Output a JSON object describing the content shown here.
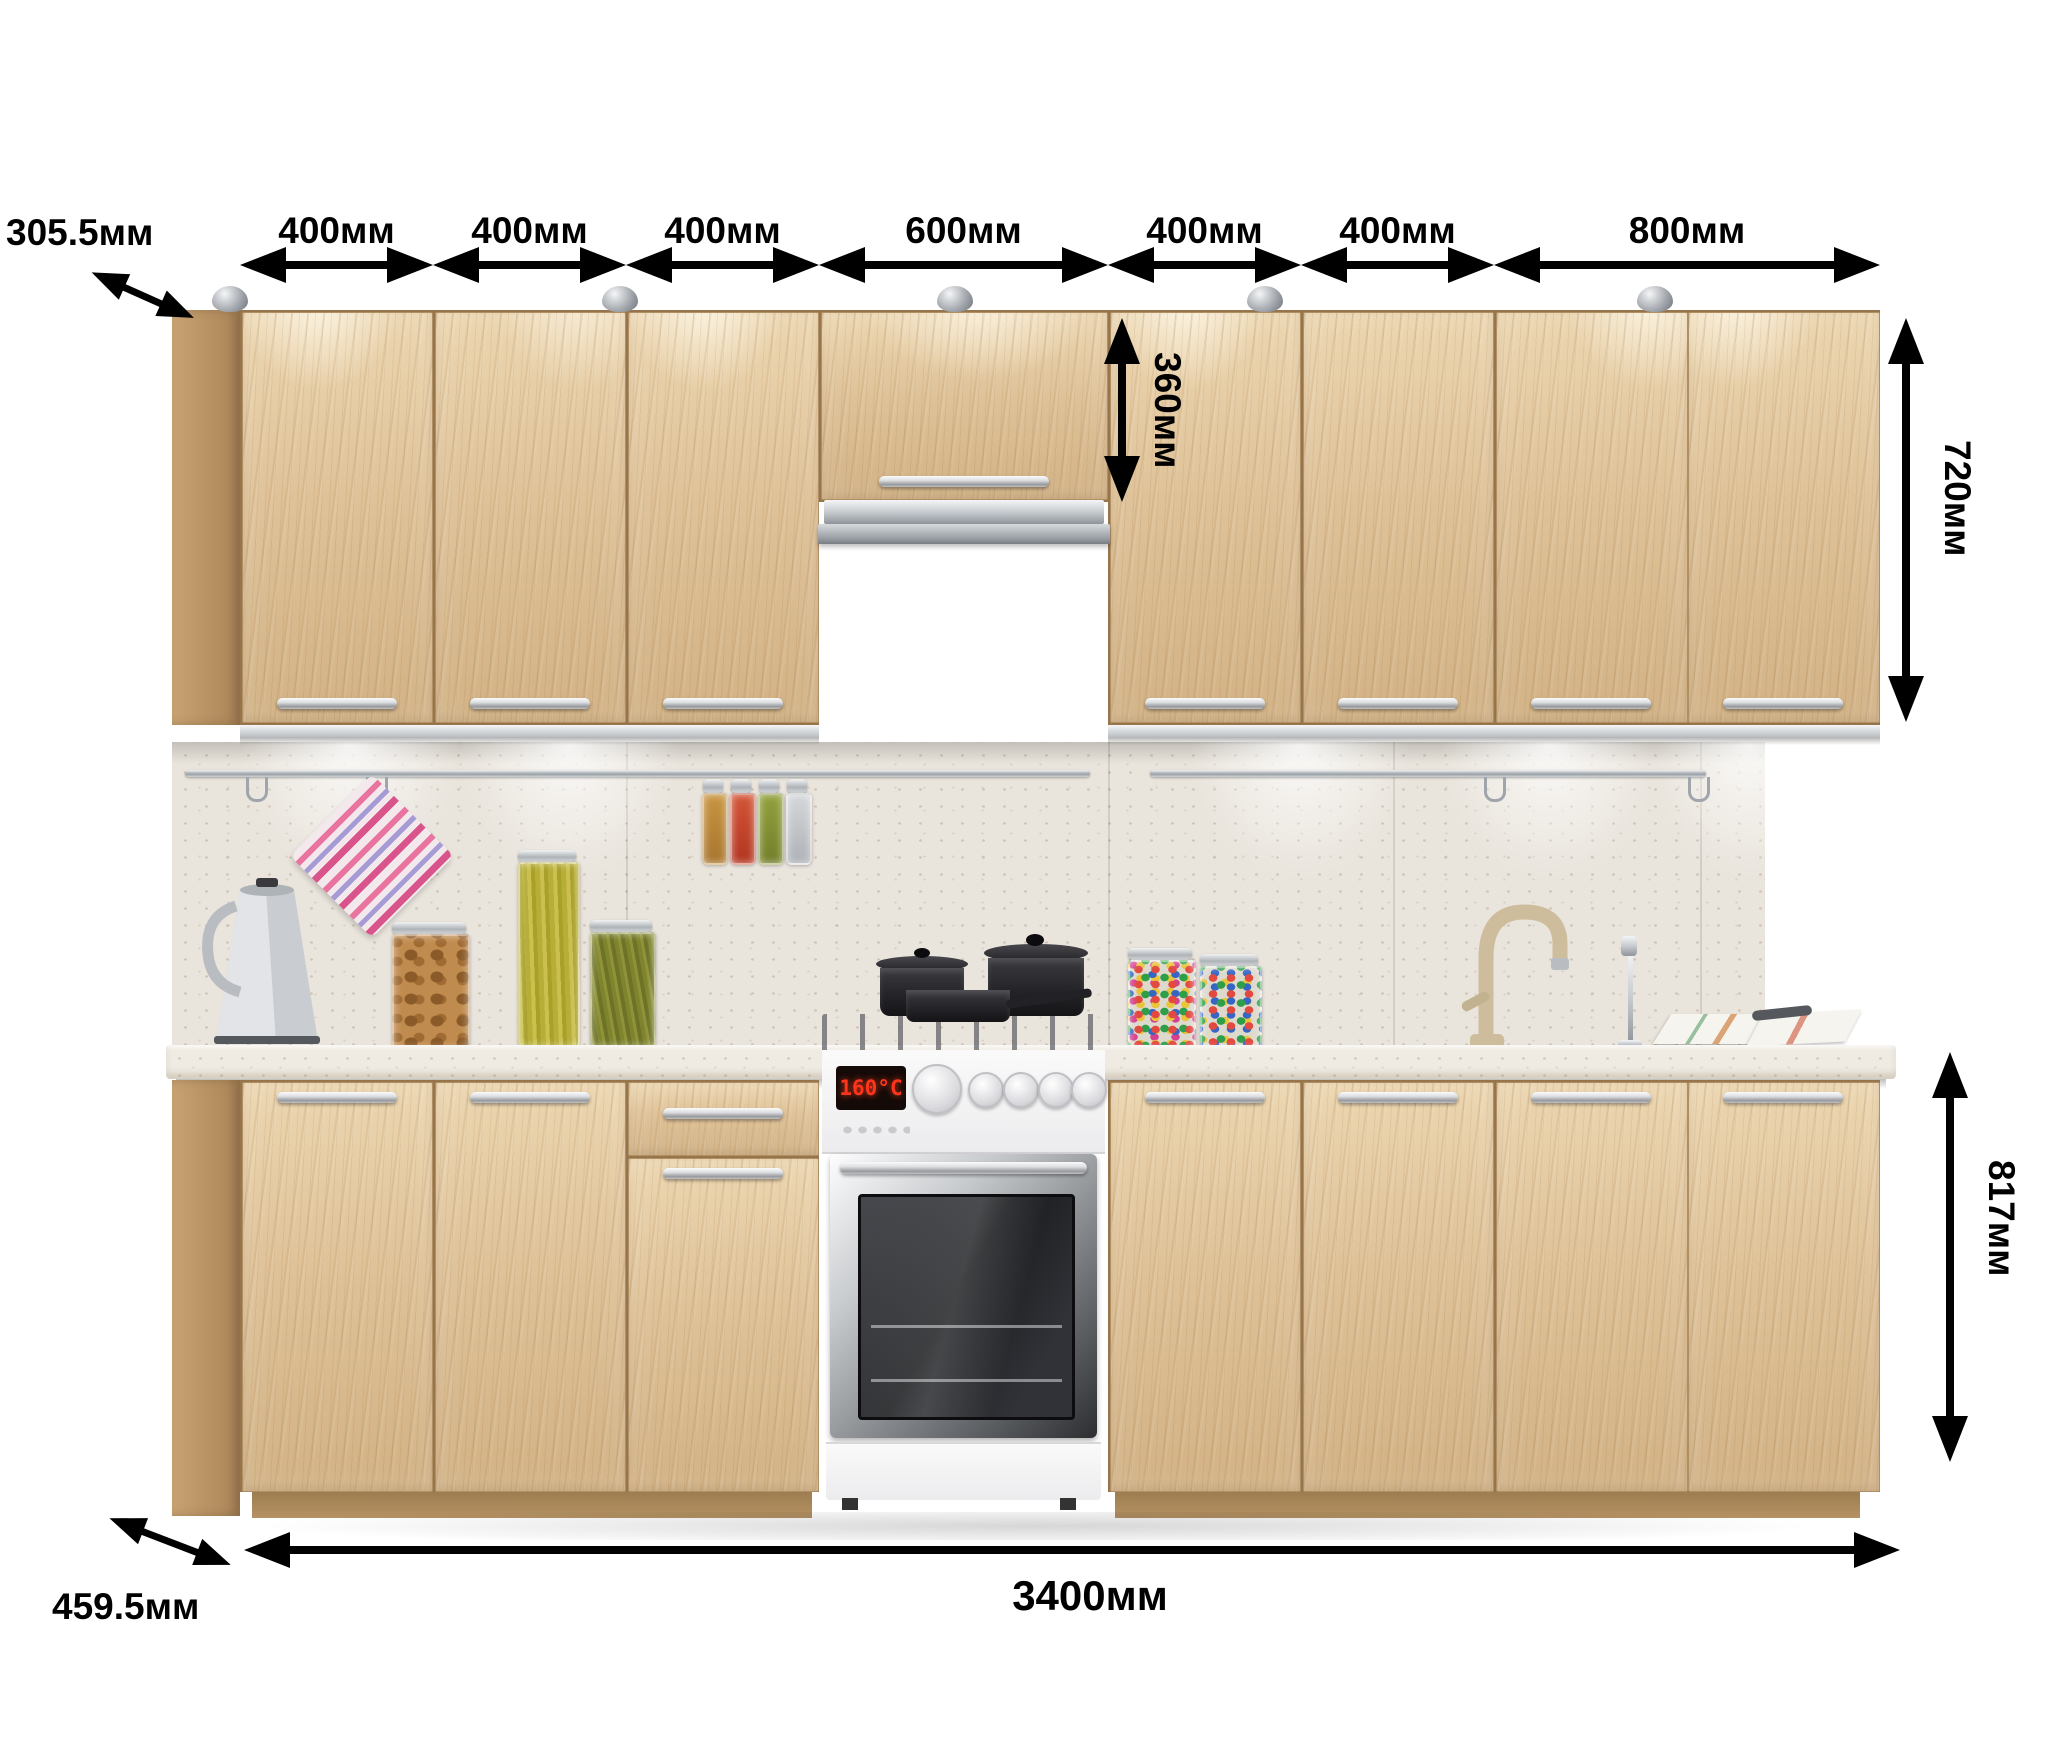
{
  "units": "мм",
  "dimensions": {
    "upper_side_depth": "305.5мм",
    "segment_widths": [
      "400мм",
      "400мм",
      "400мм",
      "600мм",
      "400мм",
      "400мм",
      "800мм"
    ],
    "hood_cabinet_height": "360мм",
    "upper_cabinet_height": "720мм",
    "base_cabinet_height": "817мм",
    "total_length": "3400мм",
    "base_side_depth": "459.5мм"
  },
  "appliances": {
    "oven_display": "160°C"
  },
  "scene_items": [
    "puck-light",
    "range-hood",
    "gas-stove",
    "oven",
    "kettle",
    "striped-towel",
    "spice-tube",
    "cookie-jar",
    "herb-jar",
    "candy-jar",
    "kitchen-sink",
    "faucet",
    "magazine",
    "cooking-pot",
    "wall-rail"
  ],
  "colors": {
    "wood": "#dfc298",
    "wood_dark": "#ab8457",
    "countertop": "#efebe2",
    "backsplash": "#e9e4dc",
    "dimension_ink": "#000000",
    "display_red": "#ff341c",
    "chrome": "#c2c6cb"
  }
}
